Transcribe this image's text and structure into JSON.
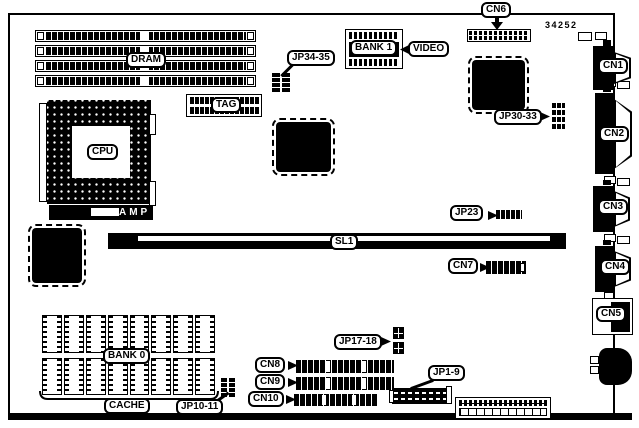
{
  "figure": {
    "part_number": "34252",
    "colors": {
      "ink": "#000000",
      "paper": "#ffffff"
    },
    "labels": {
      "cn6": "CN6",
      "dram": "DRAM",
      "jp34_35": "JP34-35",
      "bank1": "BANK 1",
      "video": "VIDEO",
      "jp30_33": "JP30-33",
      "cn1": "CN1",
      "tag": "TAG",
      "cn2": "CN2",
      "cpu": "CPU",
      "amp": "AMP",
      "jp23": "JP23",
      "cn3": "CN3",
      "sl1": "SL1",
      "cn7": "CN7",
      "cn4": "CN4",
      "cn5": "CN5",
      "jp17_18": "JP17-18",
      "bank0": "BANK 0",
      "cn8": "CN8",
      "cn9": "CN9",
      "cn10": "CN10",
      "jp1_9": "JP1-9",
      "cache": "CACHE",
      "jp10_11": "JP10-11"
    }
  }
}
